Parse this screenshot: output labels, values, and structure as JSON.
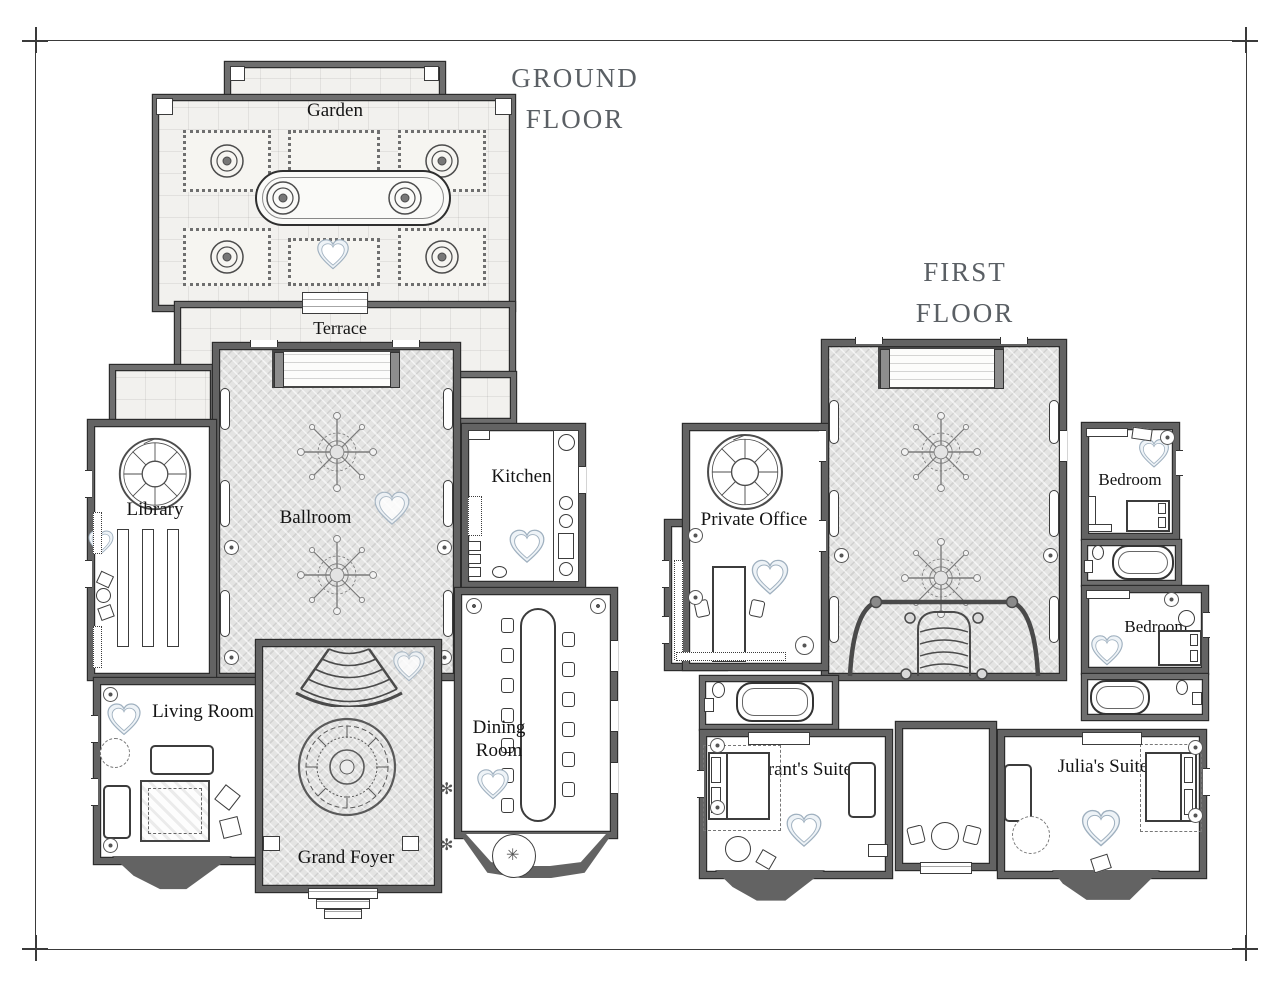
{
  "titles": {
    "ground_floor": "GROUND FLOOR",
    "first_floor": "FIRST FLOOR"
  },
  "rooms": {
    "garden": "Garden",
    "terrace": "Terrace",
    "library": "Library",
    "ballroom": "Ballroom",
    "kitchen": "Kitchen",
    "living_room": "Living Room",
    "dining_room": "Dining Room",
    "grand_foyer": "Grand Foyer",
    "private_office": "Private Office",
    "bedroom_upper": "Bedroom",
    "bedroom_lower": "Bedroom",
    "grants_suite": "Grant's Suite",
    "julias_suite": "Julia's Suite"
  },
  "glyphs": {
    "plant": "✻",
    "fan_table": "✳"
  },
  "colors": {
    "wall": "#636363",
    "herringbone_floor": "#e4e4e3",
    "stone_floor": "#f2f1ee",
    "heart_outline": "#9fb0bf",
    "heart_fill": "#eef3f7",
    "title_text": "#5a5f64",
    "label_text": "#141414",
    "line_work": "#3c3c3c"
  }
}
